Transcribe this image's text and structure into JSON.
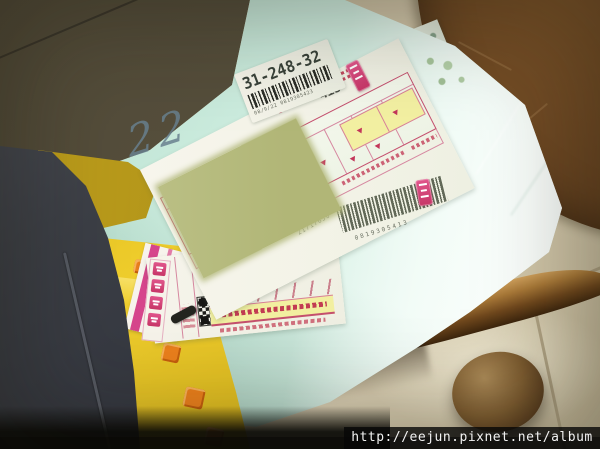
{
  "scene": {
    "watermark_url": "http://eejun.pixnet.net/album"
  },
  "parcel": {
    "handwritten_mark": "22",
    "routing_sticker": {
      "code": "31-248-32",
      "print_line": "08/9/22 0819305423"
    },
    "shipping_label": {
      "hand_number": "413",
      "checkmark": "✓",
      "waybill_number": "21717650",
      "barcode_number": "0819305413"
    }
  },
  "colors": {
    "wrap_mint": "#cfeee2",
    "label_crimson": "#c44f6e",
    "censor_olive": "#b6bb7e",
    "banner_yellow": "#f2efa0",
    "box_yellow": "#e6c222",
    "stool_wood": "#6b4622"
  }
}
